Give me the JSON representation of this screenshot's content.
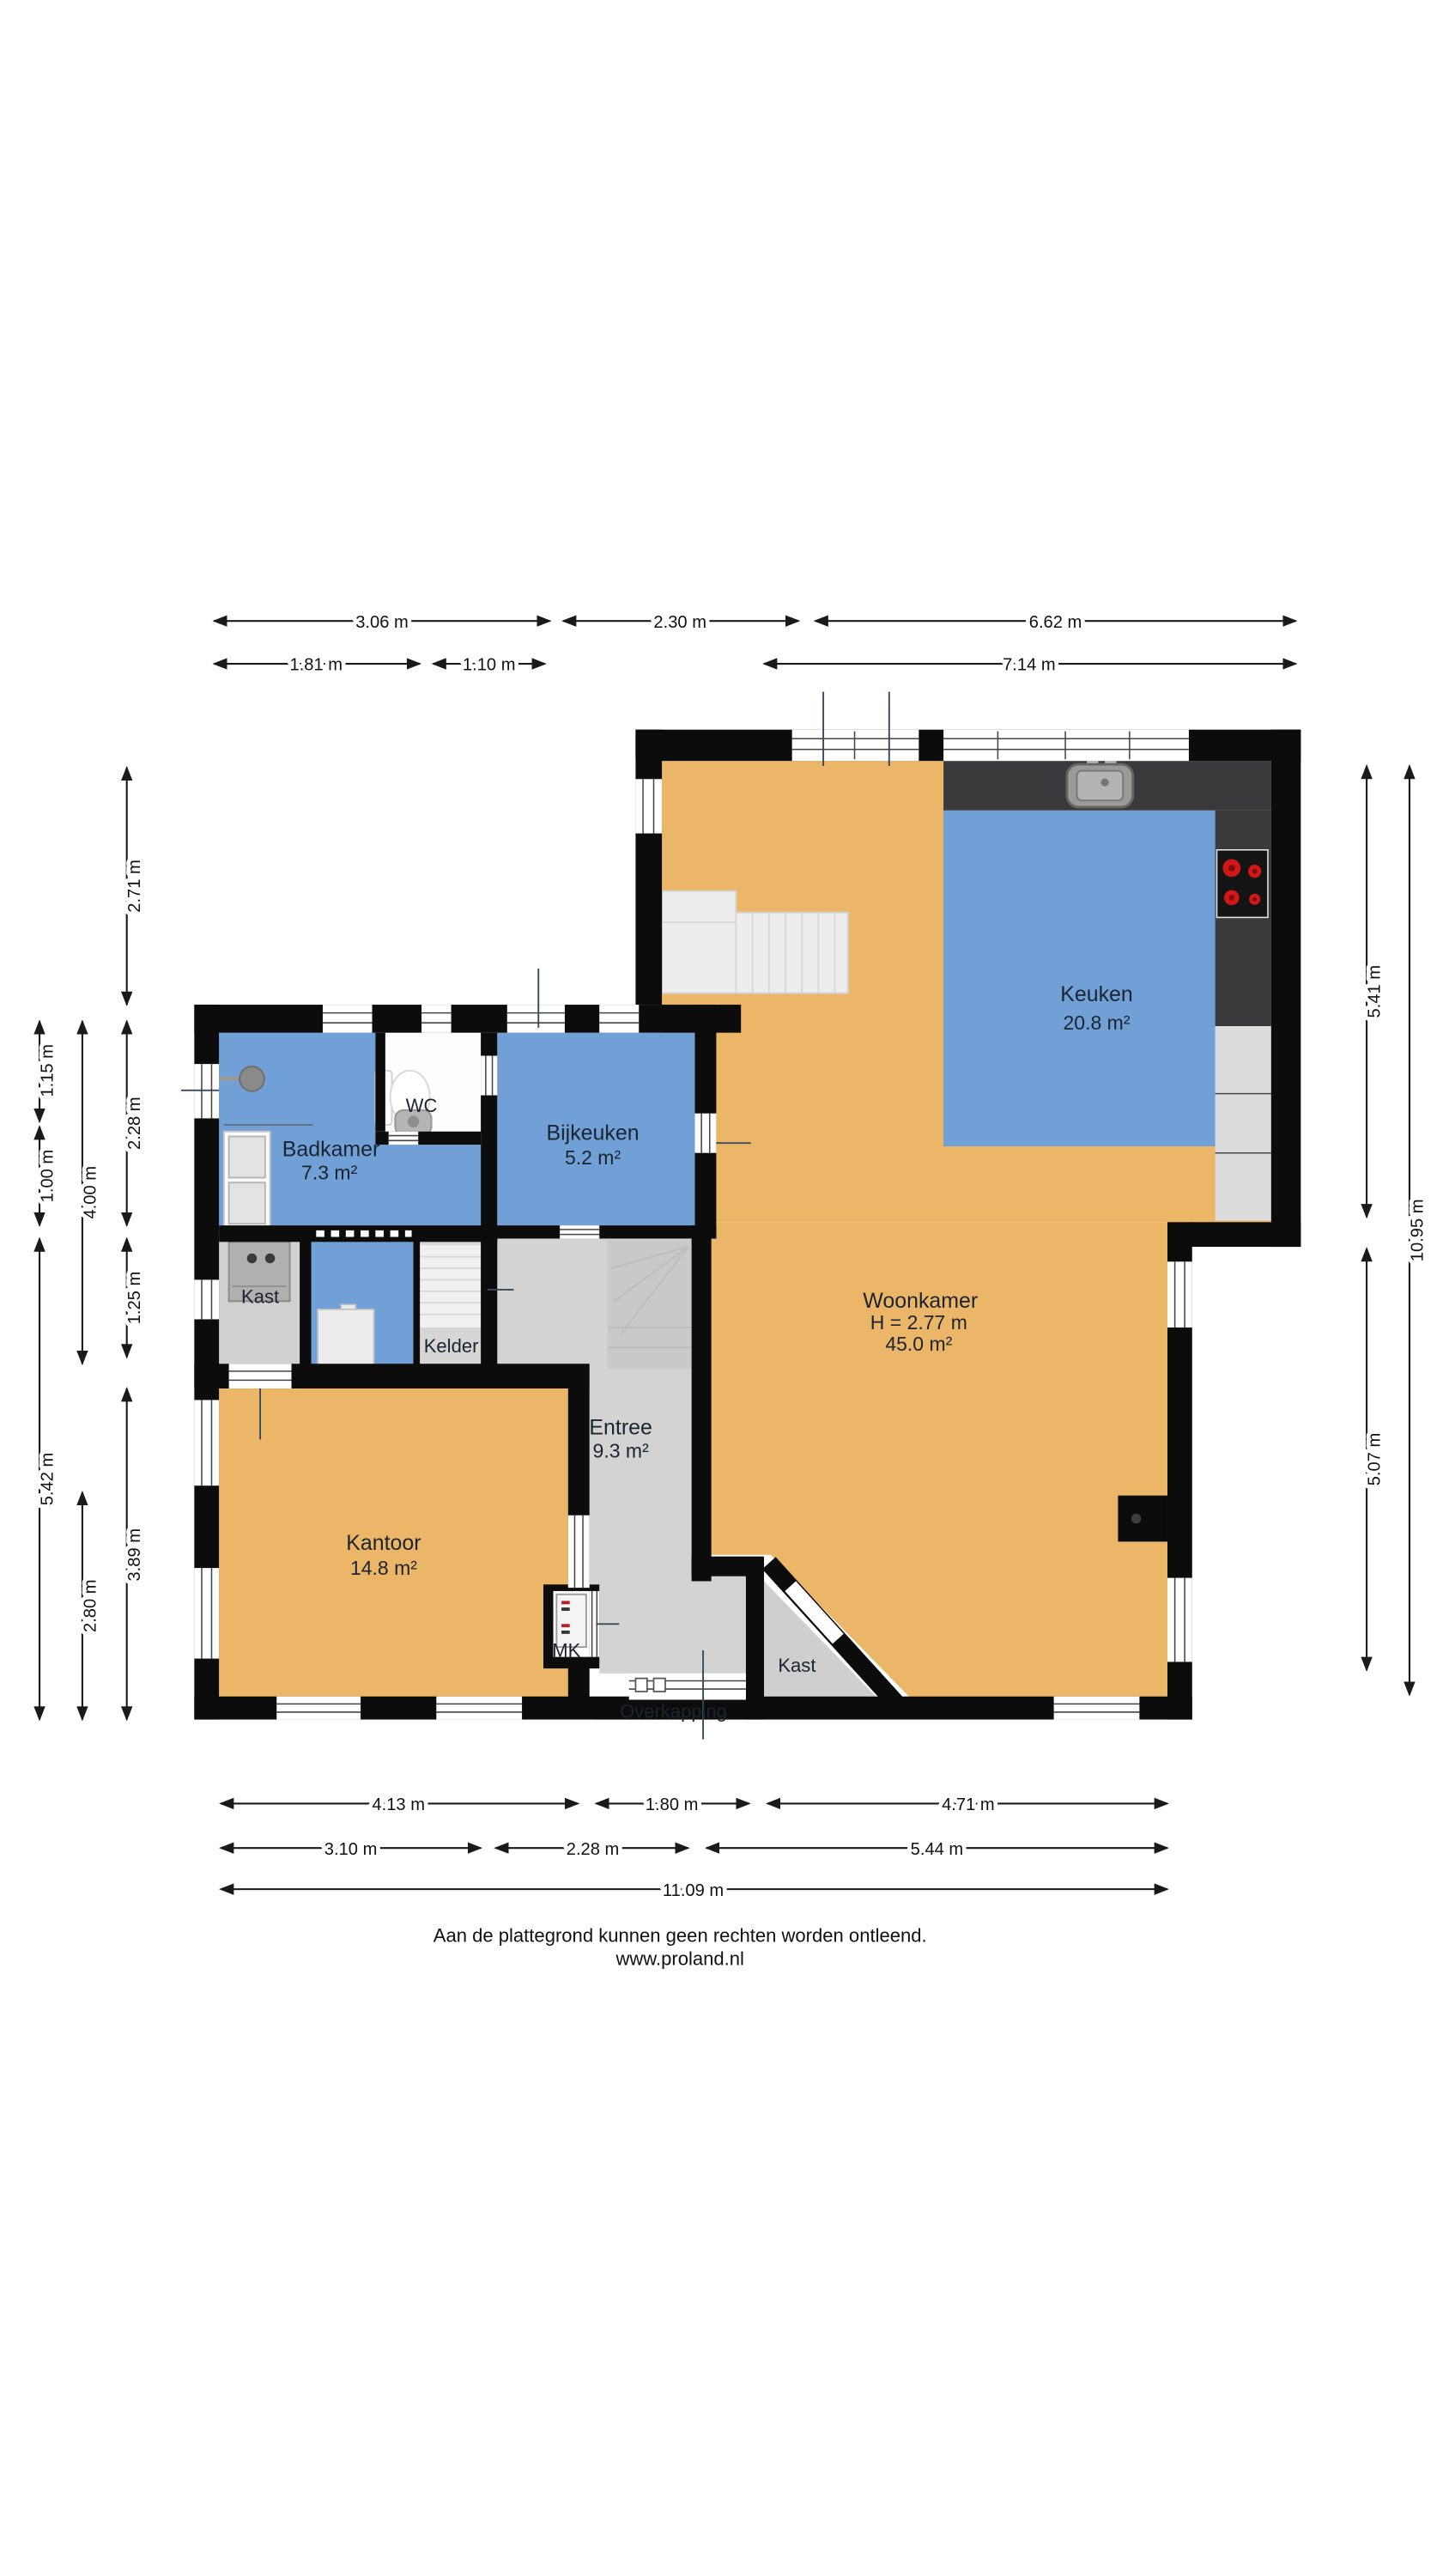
{
  "rooms": {
    "keuken": {
      "name": "Keuken",
      "area": "20.8 m²"
    },
    "badkamer": {
      "name": "Badkamer",
      "area": "7.3 m²"
    },
    "wc": {
      "name": "WC"
    },
    "bijkeuken": {
      "name": "Bijkeuken",
      "area": "5.2 m²"
    },
    "kast_badkamer": {
      "name": "Kast"
    },
    "kelder": {
      "name": "Kelder"
    },
    "woonkamer": {
      "name": "Woonkamer",
      "height": "H = 2.77 m",
      "area": "45.0 m²"
    },
    "entree": {
      "name": "Entree",
      "area": "9.3 m²"
    },
    "kantoor": {
      "name": "Kantoor",
      "area": "14.8 m²"
    },
    "mk": {
      "name": "MK"
    },
    "kast_hal": {
      "name": "Kast"
    },
    "overkapping": {
      "name": "Overkapping"
    }
  },
  "dimensions": {
    "top_row1": [
      "3.06 m",
      "2.30 m",
      "6.62 m"
    ],
    "top_row2": [
      "1.81 m",
      "1.10 m",
      "7.14 m"
    ],
    "bottom_row1": [
      "4.13 m",
      "1.80 m",
      "4.71 m"
    ],
    "bottom_row2": [
      "3.10 m",
      "2.28 m",
      "5.44 m"
    ],
    "bottom_total": "11.09 m",
    "left_outer": [
      "1.15 m",
      "1.00 m",
      "5.42 m"
    ],
    "left_middle": [
      "4.00 m",
      "2.80 m"
    ],
    "left_inner": [
      "2.71 m",
      "2.28 m",
      "1.25 m",
      "3.89 m"
    ],
    "right_inner": [
      "5.41 m",
      "5.07 m"
    ],
    "right_outer": "10.95 m"
  },
  "footer": {
    "line1": "Aan de plattegrond kunnen geen rechten worden ontleend.",
    "line2": "www.proland.nl"
  },
  "colors": {
    "floor_orange": "#ecb668",
    "floor_blue": "#70a0d6",
    "floor_gray": "#d3d3d3",
    "wall_black": "#0c0c0c",
    "counter_dark": "#3a3a3c",
    "cabinet_light": "#dcdcdc",
    "overkapping_brown": "#a87e52",
    "stove_red": "#d01818"
  }
}
